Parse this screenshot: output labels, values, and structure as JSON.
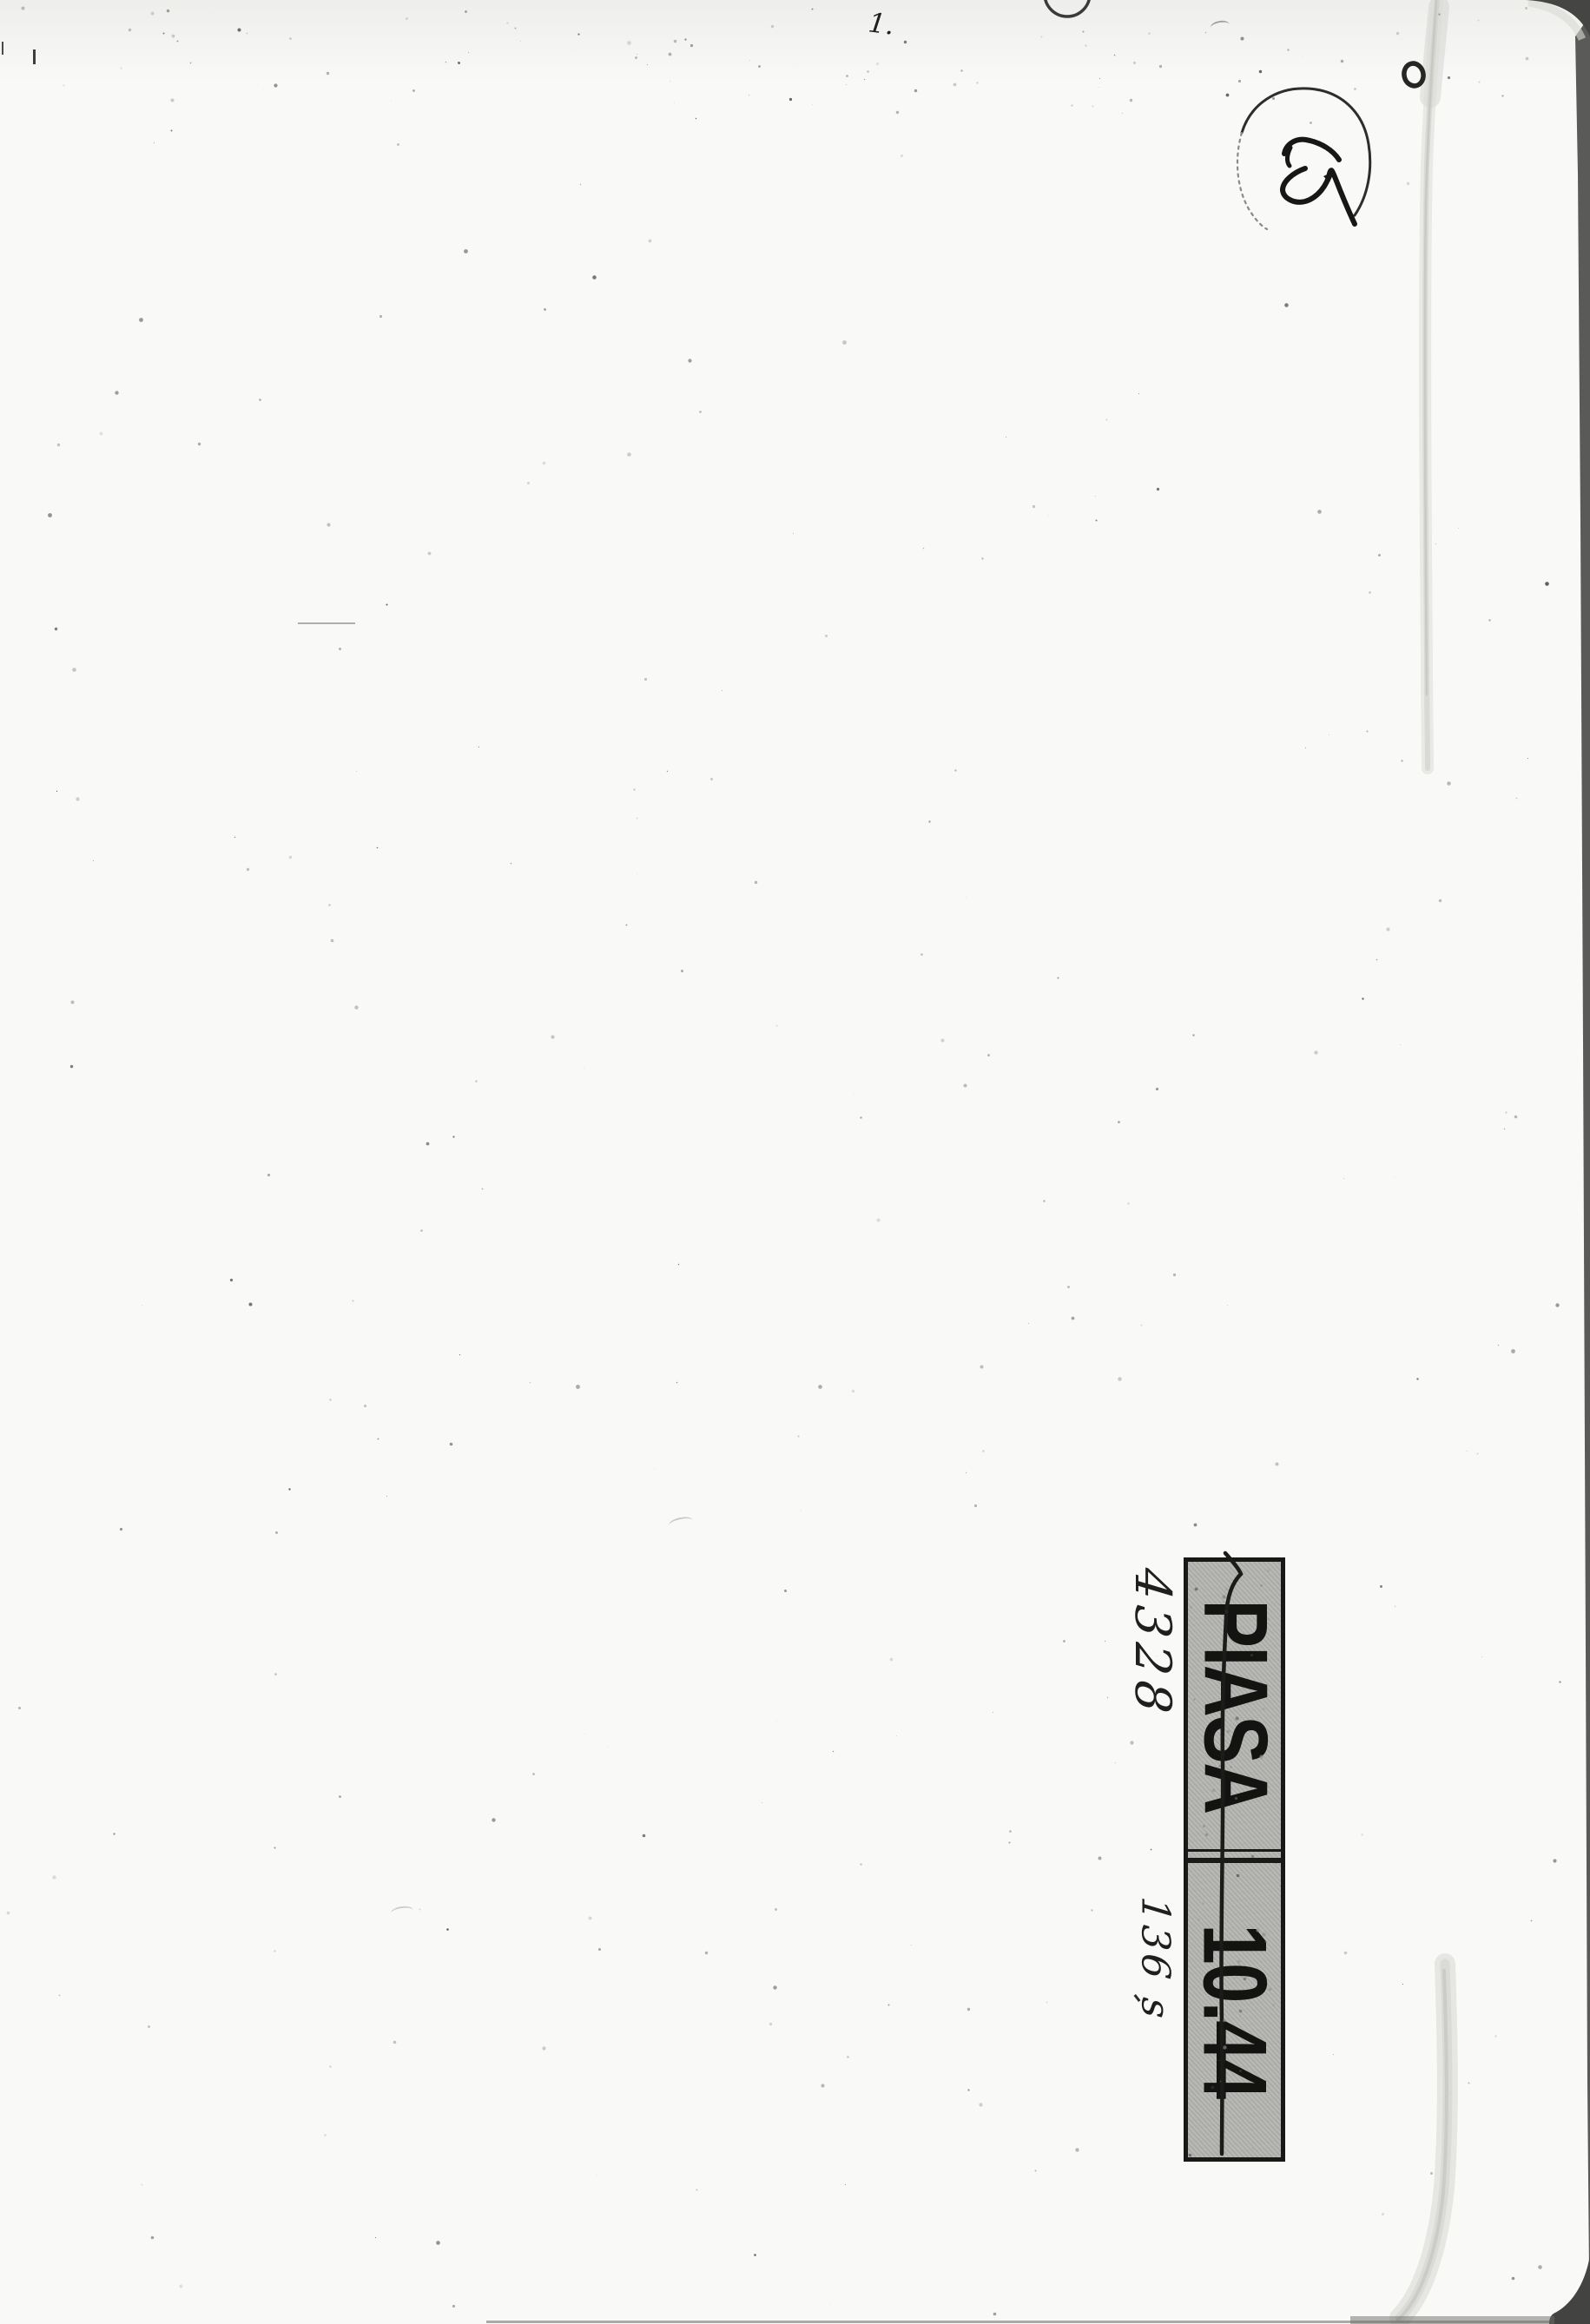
{
  "page": {
    "description": "Blank verso of a scanned album page with auction stamps and handwritten marks",
    "paper_color": "#f9f9f7",
    "backdrop_color": "#4a4a47",
    "ink_color": "#1b1b19"
  },
  "label": {
    "auction_house": "PIASA",
    "code": "10.44",
    "bg_color": "#b3b3af",
    "border_color": "#181816",
    "text_color": "#131311",
    "orientation": "rotated 90deg clockwise",
    "struck_through": true
  },
  "annotations": {
    "lot_number": "4328",
    "price_note": "136 s",
    "top_number": "1.",
    "circled_note": "45"
  }
}
